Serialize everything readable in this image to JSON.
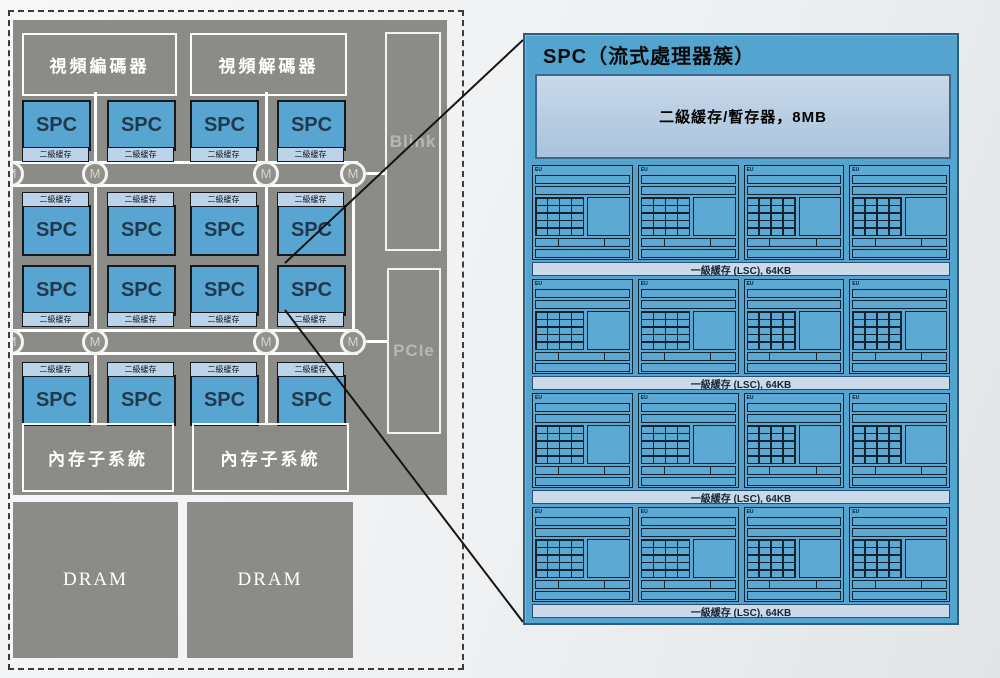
{
  "chip": {
    "video_encoder_label": "視頻編碼器",
    "video_decoder_label": "視頻解碼器",
    "blink_label": "Blink",
    "pcie_label": "PCIe",
    "spc_label": "SPC",
    "spc_cache_strip_label": "二級緩存",
    "bus_node_label": "M",
    "memory_subsystem_label": "內存子系統",
    "dram_label": "DRAM",
    "spc_count": 16
  },
  "spc_panel": {
    "title": "SPC（流式處理器簇）",
    "l2_cache_label": "二級緩存/暫存器，8MB",
    "l1_cache_strip_label": "一級緩存 (LSC), 64KB",
    "eu_tile_label": "EU",
    "grid_rows": 4,
    "grid_cols": 4
  },
  "colors": {
    "chip_gray": "#8b8b88",
    "spc_blue": "#58a5d2",
    "cache_strip_blue": "#bcd4ea",
    "panel_blue": "#54a4d0",
    "l2_box_blue": "#bdd0e4",
    "dark_line": "#152330",
    "bus_white": "#ffffff"
  }
}
